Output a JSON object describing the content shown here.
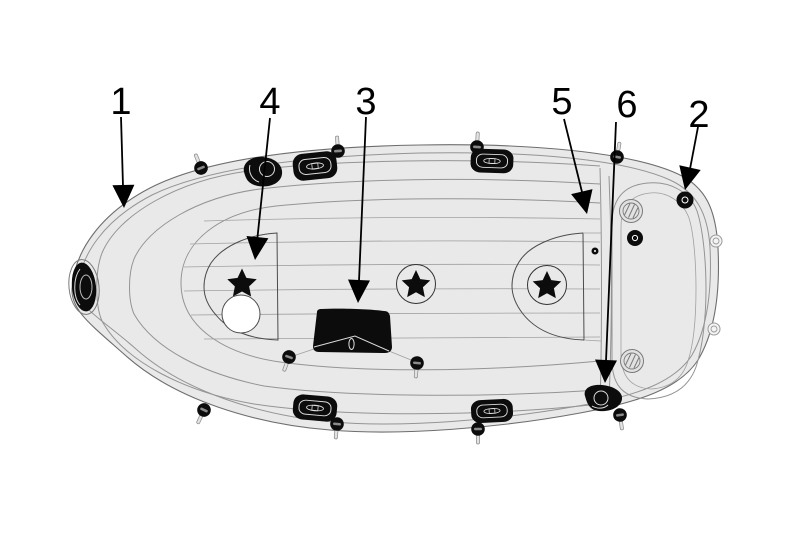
{
  "colors": {
    "background": "#ffffff",
    "hull-fill": "#e9e9e9",
    "line": "#949494",
    "ink": "#000000"
  },
  "callouts": [
    {
      "number": "1"
    },
    {
      "number": "4"
    },
    {
      "number": "3"
    },
    {
      "number": "5"
    },
    {
      "number": "6"
    },
    {
      "number": "2"
    }
  ]
}
